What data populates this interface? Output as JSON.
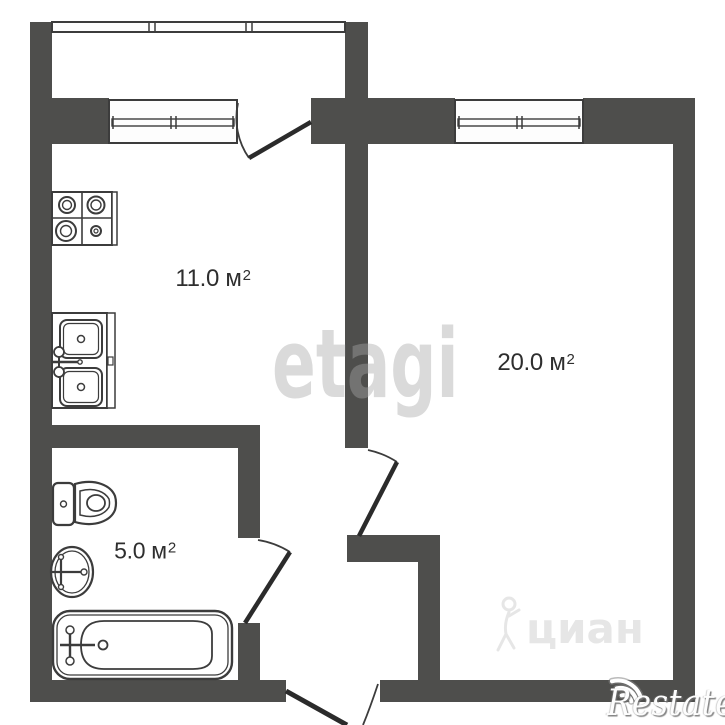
{
  "plan": {
    "type": "apartment-floor-plan",
    "rooms": {
      "kitchen": {
        "area_value": "11.0",
        "area_unit": " м",
        "area_sup": "2"
      },
      "living": {
        "area_value": "20.0",
        "area_unit": " м",
        "area_sup": "2"
      },
      "bathroom": {
        "area_value": "5.0",
        "area_unit": " м",
        "area_sup": "2"
      }
    },
    "fixtures": [
      "stove",
      "kitchen-sink",
      "toilet",
      "washbasin",
      "bathtub"
    ],
    "openings": [
      "balcony-door",
      "living-room-door",
      "bathroom-door",
      "entrance-door"
    ],
    "windows": [
      "kitchen-window",
      "living-room-window",
      "balcony-railing"
    ]
  },
  "watermarks": {
    "etagi": "etagi",
    "cian": "циан",
    "restate": "Restate"
  },
  "colors": {
    "wall": "#4e4e4c",
    "line": "#3c3c3c",
    "background": "#ffffff",
    "label": "#2e2e2e",
    "watermark_gray": "#a8a8a8"
  }
}
